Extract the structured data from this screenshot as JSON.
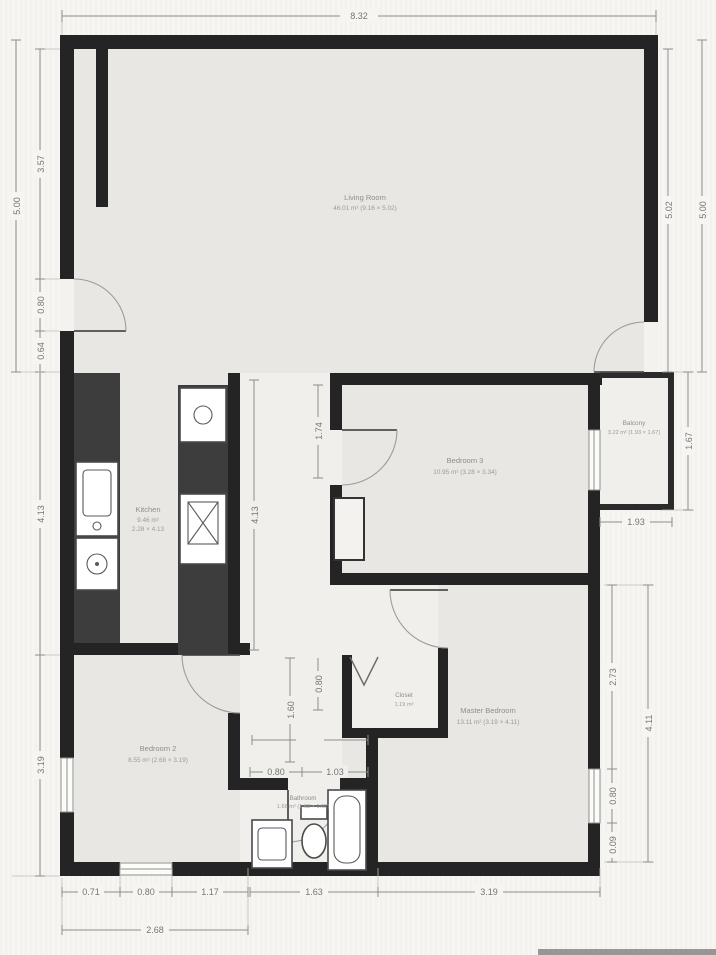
{
  "rooms": {
    "living": {
      "name": "Living Room",
      "area": "46.01 m² (9.16 × 5.02)"
    },
    "kitchen": {
      "name": "Kitchen",
      "area": "9.46 m²",
      "size": "2.28 × 4.13"
    },
    "bedroom3": {
      "name": "Bedroom 3",
      "area": "10.95 m² (3.28 × 3.34)"
    },
    "balcony": {
      "name": "Balcony",
      "area": "3.22 m² (1.93 × 1.67)"
    },
    "bedroom2": {
      "name": "Bedroom 2",
      "area": "8.55 m² (2.68 × 3.19)"
    },
    "master": {
      "name": "Master Bedroom",
      "area": "13.11 m² (3.19 × 4.11)"
    },
    "bathroom": {
      "name": "Bathroom",
      "area": "1.66 m² (1.63 × 1.02)"
    },
    "closet": {
      "name": "Closet",
      "area": "1.19 m²"
    }
  },
  "dims": {
    "top_width": "8.32",
    "left_total": "5.00",
    "left_seg1": "3.57",
    "left_entry": "0.80",
    "left_seg3": "0.64",
    "left_kitchen": "4.13",
    "left_bedroom2": "3.19",
    "right_living_inner": "5.02",
    "right_living_outer": "5.00",
    "balcony_height": "1.67",
    "balcony_width": "1.93",
    "master_seg1": "2.73",
    "master_window": "0.80",
    "master_seg3": "0.09",
    "master_height": "4.11",
    "bottom_b2_seg1": "0.71",
    "bottom_b2_window": "0.80",
    "bottom_b2_seg3": "1.17",
    "bottom_b2_total": "2.68",
    "bottom_bath": "1.63",
    "bottom_master": "3.19",
    "hall_top": "1.74",
    "kitchen_inner": "4.13",
    "corridor_len": "1.60",
    "closet_door": "0.80",
    "bath_seg1": "0.80",
    "bath_seg2": "1.03"
  },
  "colors": {
    "wall": "#242424",
    "floor": "#e8e7e3",
    "paper": "#f6f5f2",
    "dimension": "#8d8d8d"
  }
}
